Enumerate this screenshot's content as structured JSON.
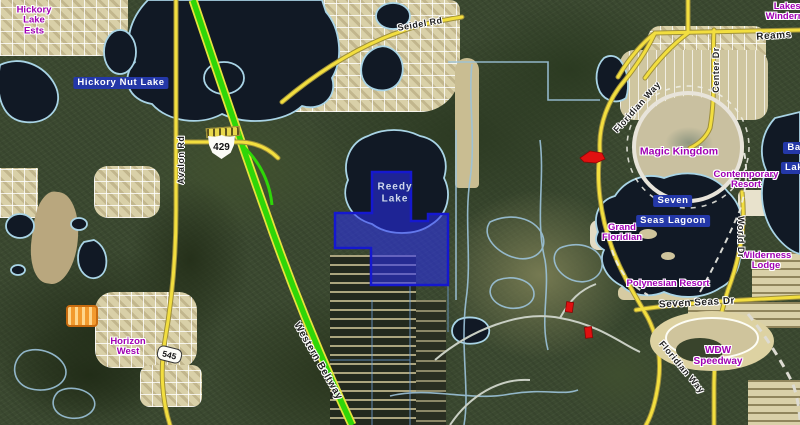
{
  "map": {
    "description": "Aerial GIS parcel map of the Walt Disney World / Horizon West area with a selected parcel highlighted in blue near Reedy Lake",
    "place_labels": [
      {
        "id": "hickory-lake-ests",
        "line1": "Hickory",
        "line2": "Lake",
        "line3": "Ests"
      },
      {
        "id": "horizon-west",
        "line1": "Horizon",
        "line2": "West"
      },
      {
        "id": "magic-kingdom",
        "line1": "Magic Kingdom"
      },
      {
        "id": "contemporary-resort",
        "line1": "Contemporary",
        "line2": "Resort"
      },
      {
        "id": "grand-floridian",
        "line1": "Grand",
        "line2": "Floridian"
      },
      {
        "id": "polynesian-resort",
        "line1": "Polynesian Resort"
      },
      {
        "id": "wilderness-lodge",
        "line1": "Wilderness",
        "line2": "Lodge"
      },
      {
        "id": "wdw-speedway",
        "line1": "WDW",
        "line2": "Speedway"
      },
      {
        "id": "lakes-of-windermere",
        "line1": "Lakes of",
        "line2": "Windermere"
      }
    ],
    "water_labels": [
      {
        "id": "hickory-nut-lake",
        "line1": "Hickory Nut Lake"
      },
      {
        "id": "seven-seas-lagoon",
        "line1": "Seven",
        "line2": "Seas Lagoon"
      },
      {
        "id": "bay-lake",
        "line1": "Bay",
        "line2": "Lake"
      },
      {
        "id": "reedy-lake",
        "line1": "Reedy",
        "line2": "Lake"
      }
    ],
    "road_labels": [
      {
        "id": "seidel-rd",
        "text": "Seidel Rd"
      },
      {
        "id": "avalon-rd",
        "text": "Avalon Rd"
      },
      {
        "id": "western-beltway",
        "text": "Western Beltway"
      },
      {
        "id": "floridian-way-north",
        "text": "Floridian Way"
      },
      {
        "id": "floridian-way-south",
        "text": "Floridian Way"
      },
      {
        "id": "world-dr",
        "text": "World Dr"
      },
      {
        "id": "seven-seas-dr",
        "text": "Seven Seas Dr"
      },
      {
        "id": "center-dr",
        "text": "Center Dr"
      },
      {
        "id": "reams",
        "text": "Reams"
      }
    ],
    "shields": [
      {
        "id": "route-429",
        "number": "429"
      },
      {
        "id": "route-545",
        "number": "545"
      }
    ],
    "colors": {
      "selected_parcel": "#2a2df2",
      "place_label": "#a000b4",
      "water_label_bg": "#2438a8",
      "highway_green": "#2fd608",
      "road_yellow": "#f2de3f"
    }
  }
}
